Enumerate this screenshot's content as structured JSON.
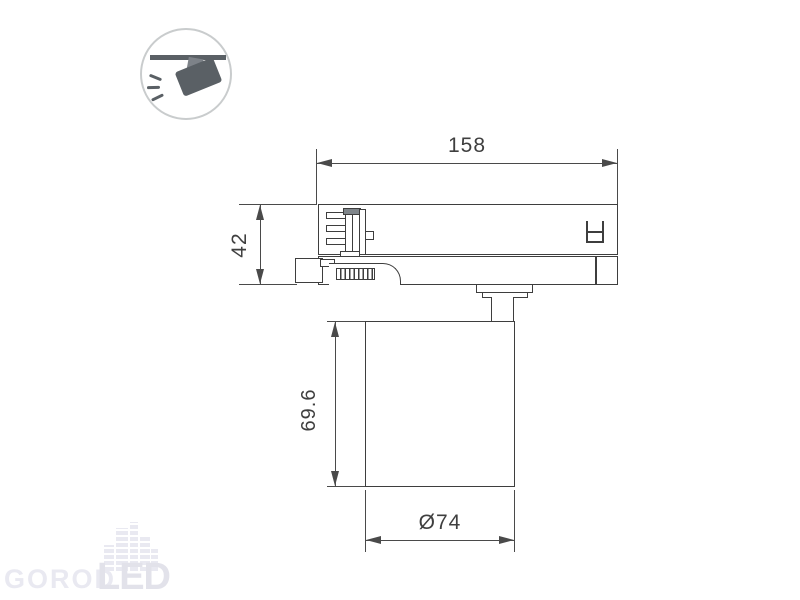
{
  "dimensions": {
    "track_length": {
      "label": "158"
    },
    "adapter_height": {
      "label": "42"
    },
    "body_height": {
      "label": "69.6"
    },
    "body_diameter": {
      "label": "Ø74"
    }
  },
  "watermark": {
    "gorod": "GOROD",
    "led": "LED"
  },
  "icons": {
    "corner_badge": "track-mounted-spotlight-pictogram"
  },
  "colors": {
    "line": "#3e3e3e",
    "dim": "#4a4a4a",
    "text": "#3f3f3f",
    "icon_dark": "#5a6065",
    "icon_mid": "#7d8288",
    "circle_border": "#c9cccd",
    "watermark": "#e9e9f1",
    "watermark_dark": "#e2e2ea",
    "background": "#ffffff"
  }
}
